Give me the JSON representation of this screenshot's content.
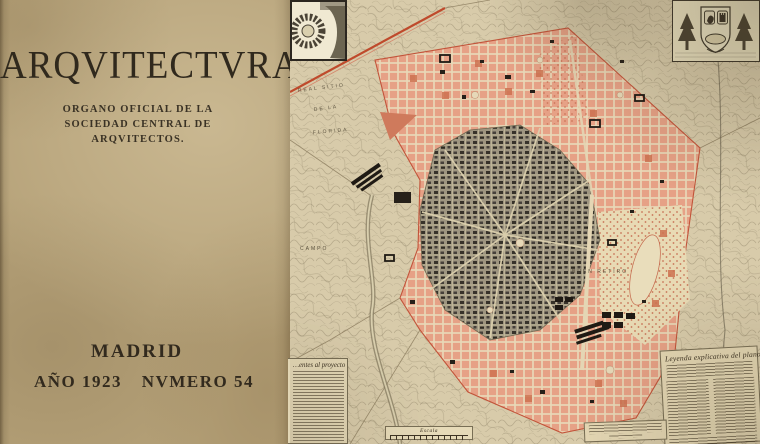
{
  "cover": {
    "title": "ARQVITECTVRA",
    "subtitle_line1": "ORGANO OFICIAL DE LA",
    "subtitle_line2": "SOCIEDAD CENTRAL DE",
    "subtitle_line3": "ARQVITECTOS.",
    "city": "MADRID",
    "year": "AÑO 1923",
    "issue": "NVMERO 54"
  },
  "map": {
    "labels": {
      "real_sitio": "REAL SITIO",
      "de_la": "DE LA",
      "florida": "FLORIDA",
      "campo": "CAMPO",
      "buen_retiro": "BUEN RETIRO"
    },
    "legend": {
      "title": "Leyenda explicativa del plano"
    },
    "notes": {
      "title": "…entes al proyecto"
    },
    "scale": {
      "label": "Escala"
    },
    "colors": {
      "cover_paper": "#b5a178",
      "map_paper": "#d8cbaa",
      "ensanche_pink": "#e9a78d",
      "accent_red": "#c0512f",
      "old_city_gray": "#9e9580",
      "ink": "#30291d"
    }
  }
}
